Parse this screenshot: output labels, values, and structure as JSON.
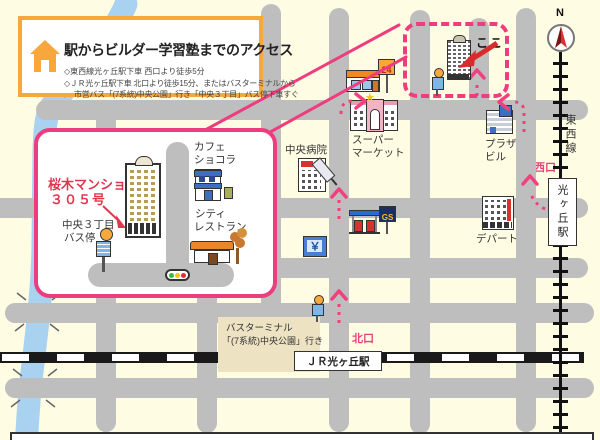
{
  "colors": {
    "background": "#FFFCE4",
    "road": "#BEBEBE",
    "route_pink": "#F2407E",
    "border_pink": "#EE3D7F",
    "orange": "#F7A73C",
    "red": "#D92B2B",
    "river_blue": "#A8D2F0",
    "terminal_tan": "#EDE2C2"
  },
  "title_box": {
    "title": "駅からビルダー学習塾までのアクセス",
    "lines": [
      "◇東西線光ヶ丘駅下車 西口より徒歩5分",
      "◇ＪＲ光ヶ丘駅下車 北口より徒歩15分、またはバスターミナルから",
      "市営バス「(7系統)中央公園」行き「中央３丁目」バス停下車すぐ"
    ]
  },
  "inset": {
    "mansion_line1": "桜木マンション",
    "mansion_line2": "３０５号",
    "cafe_line1": "カフェ",
    "cafe_line2": "ショコラ",
    "restaurant_line1": "シティ",
    "restaurant_line2": "レストラン",
    "busstop_line1": "中央３丁目",
    "busstop_line2": "バス停"
  },
  "map": {
    "koko": "ここ",
    "hospital": "中央病院",
    "supermarket_line1": "スーパー",
    "supermarket_line2": "マーケット",
    "plaza_line1": "プラザ",
    "plaza_line2": "ビル",
    "department_store": "デパート",
    "tozai_line": "東西線",
    "west_exit": "西口",
    "north_exit": "北口",
    "hikarigaoka_station": "光ヶ丘駅",
    "jr_station": "ＪＲ光ヶ丘駅",
    "bus_terminal_line1": "バスターミナル",
    "bus_terminal_line2": "「(7系統)中央公園」行き",
    "conv_sign": "24",
    "gs_sign": "GS",
    "yen_sign": "￥",
    "star": "★",
    "compass_n": "N"
  }
}
